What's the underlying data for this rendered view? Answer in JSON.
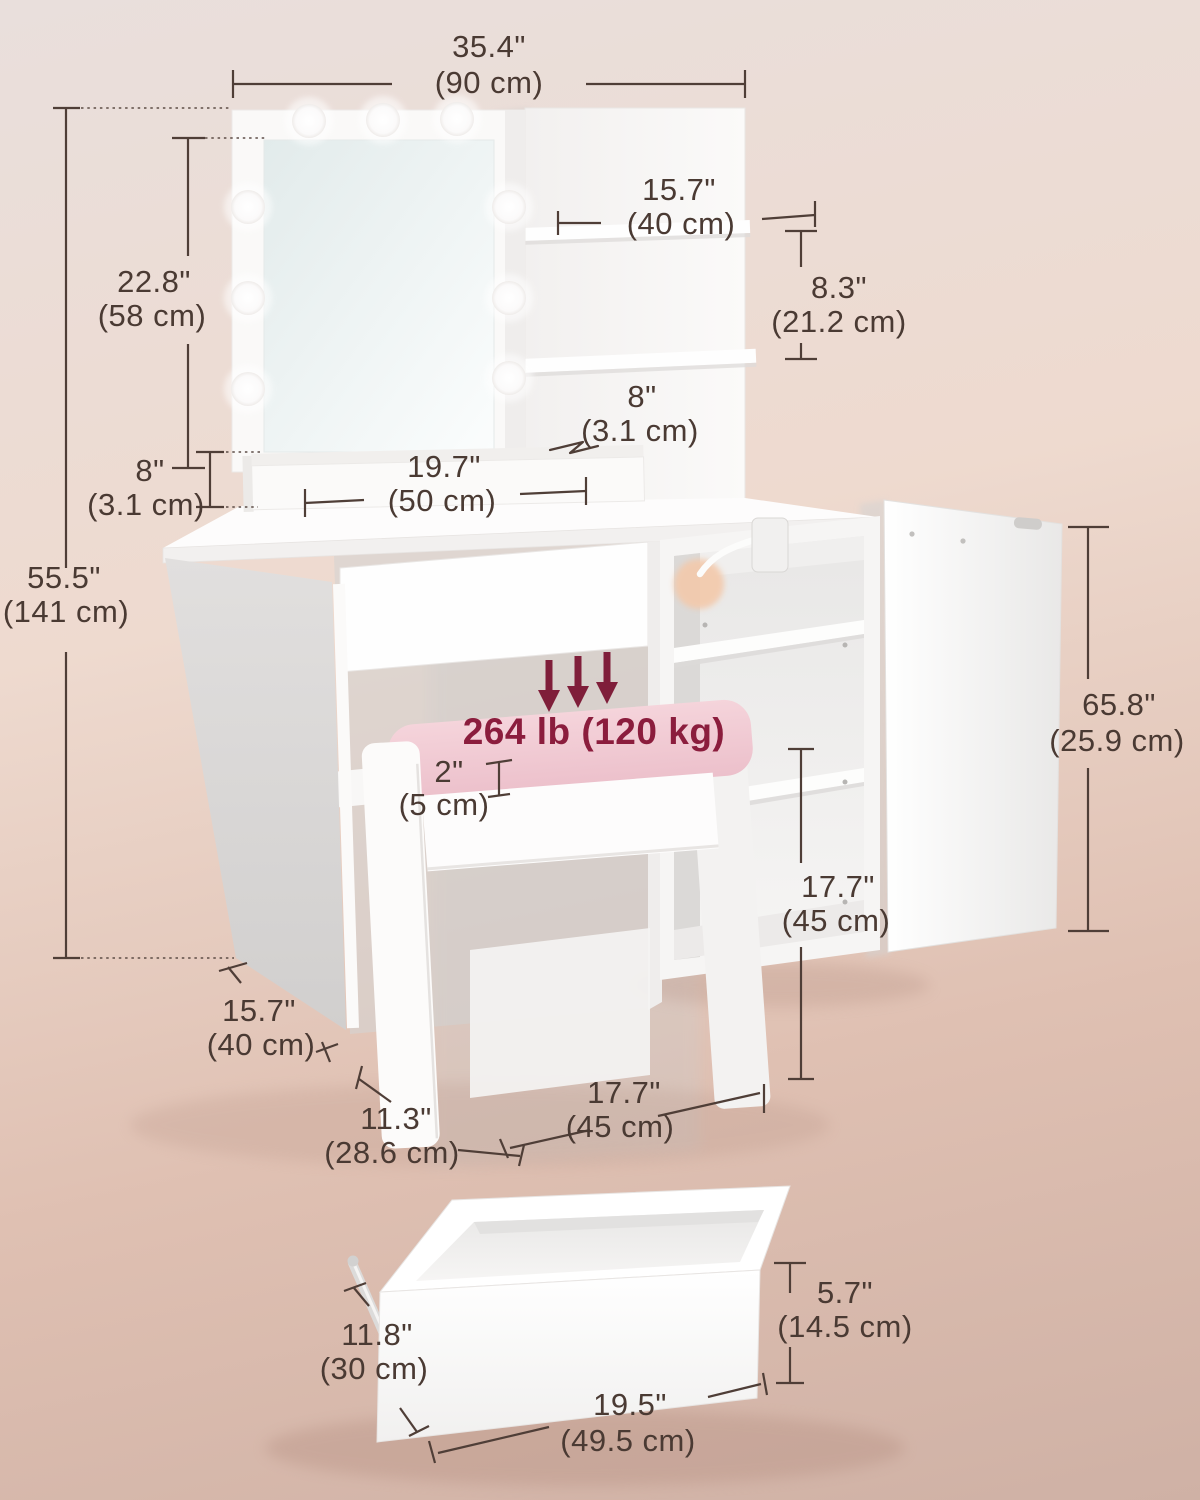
{
  "diagram": {
    "weight_capacity": "264 lb (120 kg)",
    "dimensions": {
      "overall_width": {
        "in": "35.4\"",
        "cm": "(90 cm)"
      },
      "shelf_width": {
        "in": "15.7\"",
        "cm": "(40 cm)"
      },
      "shelf_gap": {
        "in": "8.3\"",
        "cm": "(21.2 cm)"
      },
      "mirror_height": {
        "in": "22.8\"",
        "cm": "(58 cm)"
      },
      "ledge_height": {
        "in": "8\"",
        "cm": "(3.1 cm)"
      },
      "shelf_thickness": {
        "in": "8\"",
        "cm": "(3.1 cm)"
      },
      "ledge_width": {
        "in": "19.7\"",
        "cm": "(50 cm)"
      },
      "total_height": {
        "in": "55.5\"",
        "cm": "(141 cm)"
      },
      "cushion_height": {
        "in": "2\"",
        "cm": "(5 cm)"
      },
      "door_width": {
        "in": "65.8\"",
        "cm": "(25.9 cm)"
      },
      "cabinet_inner_height": {
        "in": "17.7\"",
        "cm": "(45 cm)"
      },
      "desk_depth": {
        "in": "15.7\"",
        "cm": "(40 cm)"
      },
      "stool_depth": {
        "in": "11.3\"",
        "cm": "(28.6 cm)"
      },
      "stool_width": {
        "in": "17.7\"",
        "cm": "(45 cm)"
      },
      "drawer_height": {
        "in": "5.7\"",
        "cm": "(14.5 cm)"
      },
      "drawer_depth": {
        "in": "11.8\"",
        "cm": "(30 cm)"
      },
      "drawer_width": {
        "in": "19.5\"",
        "cm": "(49.5 cm)"
      }
    }
  },
  "colors": {
    "background_top": "#e9dfdc",
    "background_bottom": "#cfb1a5",
    "dimension_line": "#4f3e37",
    "weight_accent": "#8b1d3d",
    "cushion_pink": "#f3ccd5",
    "furniture_white": "#fdfcfc"
  }
}
